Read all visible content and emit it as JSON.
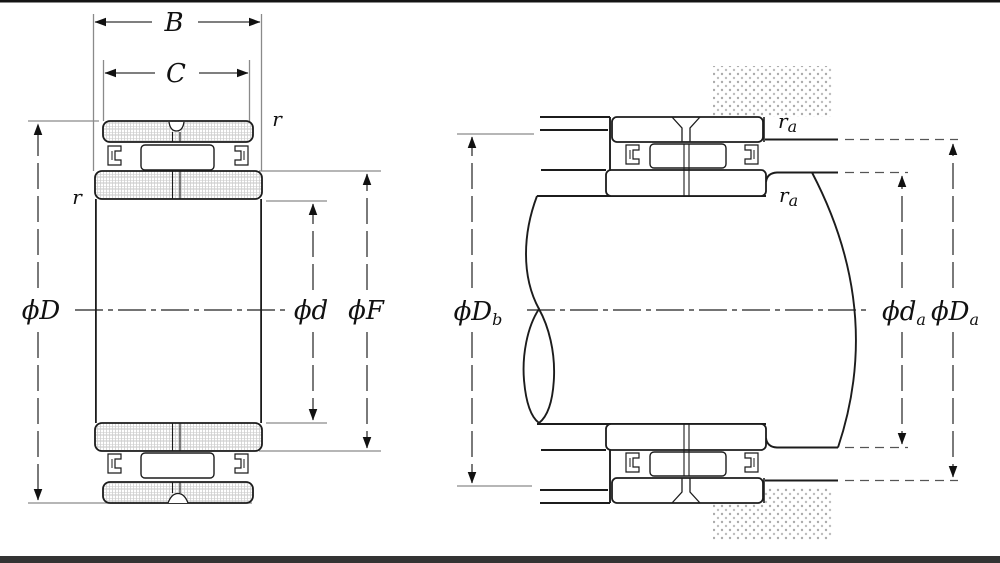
{
  "left": {
    "labels": {
      "B": "B",
      "C": "C",
      "D": "ϕD",
      "d": "ϕd",
      "F": "ϕF",
      "r_top": "r",
      "r_side": "r"
    }
  },
  "right": {
    "labels": {
      "Db": {
        "main": "ϕD",
        "sub": "b"
      },
      "da": {
        "main": "ϕd",
        "sub": "a"
      },
      "Da": {
        "main": "ϕD",
        "sub": "a"
      },
      "ra_top": {
        "main": "r",
        "sub": "a"
      },
      "ra_shaft": {
        "main": "r",
        "sub": "a"
      }
    }
  },
  "colors": {
    "line": "#1c1c1c",
    "dim_line": "#333333",
    "ext_line": "#8a8a8a",
    "hatch": "#c4c4c4",
    "stipple": "#ababab",
    "top_bar": "#141414",
    "bottom_bar": "#333333",
    "background": "#ffffff"
  }
}
